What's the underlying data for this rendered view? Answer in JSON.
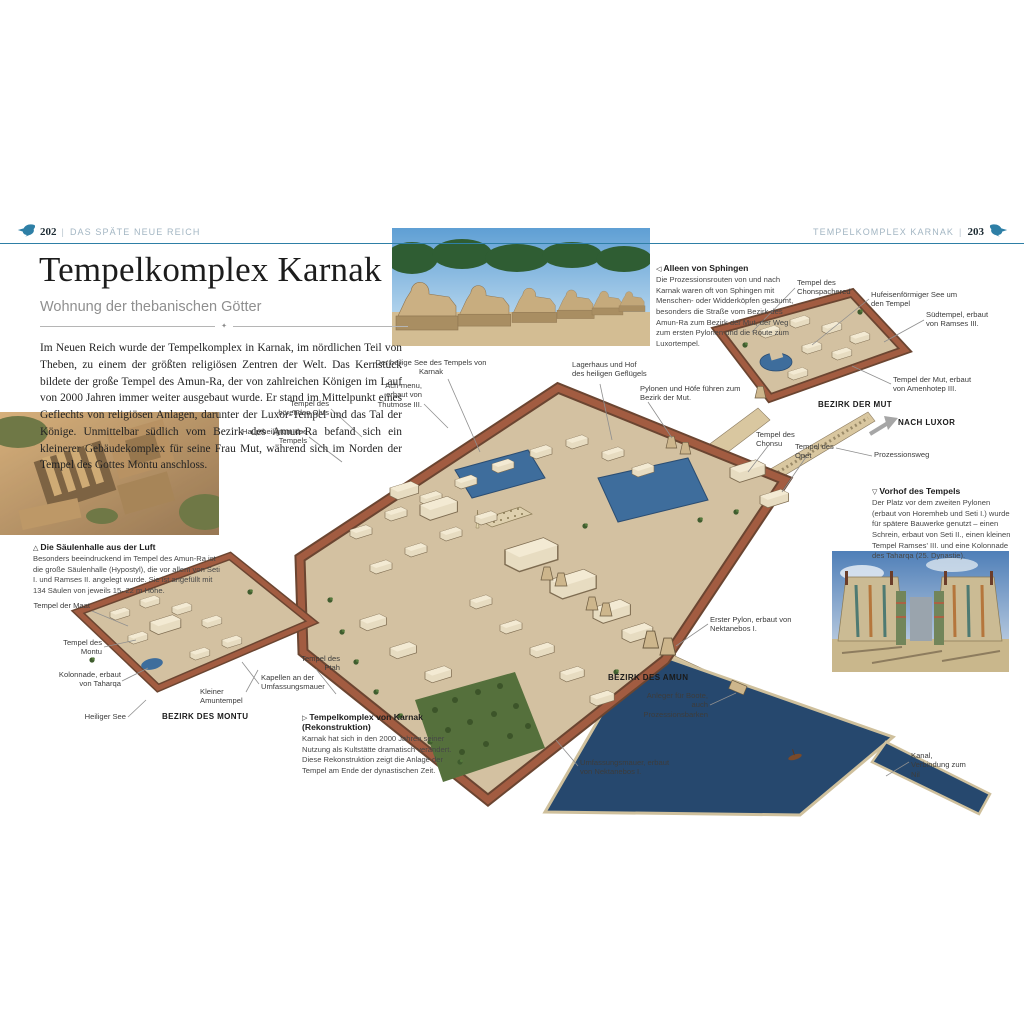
{
  "header": {
    "left_page": "202",
    "left_chapter": "DAS SPÄTE NEUE REICH",
    "right_chapter": "TEMPELKOMPLEX KARNAK",
    "right_page": "203",
    "separator": "|"
  },
  "article": {
    "title": "Tempelkomplex Karnak",
    "subtitle": "Wohnung der thebanischen Götter",
    "intro": "Im Neuen Reich wurde der Tempelkomplex in Karnak, im nördlichen Teil von Theben, zu einem der größten religiösen Zentren der Welt. Das Kernstück bildete der große Tempel des Amun-Ra, der von zahlreichen Königen im Lauf von 2000 Jahren immer weiter ausgebaut wurde. Er stand im Mittelpunkt eines Geflechts von religiösen Anlagen, darunter der Luxor-Tempel und das Tal der Könige. Unmittelbar südlich vom Bezirk des Amun-Ra befand sich ein kleinerer Gebäudekomplex für seine Frau Mut, während sich im Norden der Tempel des Gottes Montu anschloss."
  },
  "captions": {
    "sphingen": {
      "marker": "◁",
      "title": "Alleen von Sphingen",
      "body": "Die Prozessionsrouten von und nach Karnak waren oft von Sphingen mit Menschen- oder Widderköpfen gesäumt, besonders die Straße vom Bezirk des Amun-Ra zum Bezirk der Mut, der Weg zum ersten Pylonen und die Route zum Luxortempel."
    },
    "vorhof": {
      "marker": "▽",
      "title": "Vorhof des Tempels",
      "body": "Der Platz vor dem zweiten Pylonen (erbaut von Horemheb und Seti I.) wurde für spätere Bauwerke genutzt – einen Schrein, erbaut von Seti II., einen kleinen Tempel Ramses' III. und eine Kolonnade des Taharqa (25. Dynastie)."
    },
    "saeulenhalle": {
      "marker": "△",
      "title": "Die Säulenhalle aus der Luft",
      "body": "Besonders beeindruckend im Tempel des Amun-Ra ist die große Säulenhalle (Hypostyl), die vor allem von Seti I. und Ramses II. angelegt wurde. Sie ist angefüllt mit 134 Säulen von jeweils 15–22 m Höhe."
    },
    "rekonstruktion": {
      "marker": "▷",
      "title": "Tempelkomplex von Karnak (Rekonstruktion)",
      "body": "Karnak hat sich in den 2000 Jahren seiner Nutzung als Kultstätte dramatisch verändert. Diese Rekonstruktion zeigt die Anlage der Tempel am Ende der dynastischen Zeit."
    }
  },
  "labels": {
    "hoerendes_ohr": "Tempel des hörenden Ohrs",
    "hauptheiligtum": "Hauptheiligtum des Tempels",
    "ach_menu": "Ach-menu, erbaut von Thutmose III.",
    "heiliger_see_karnak": "Der heilige See des Tempels von Karnak",
    "lagerhaus": "Lagerhaus und Hof des heiligen Geflügels",
    "pylonen_hoefe": "Pylonen und Höfe führen zum Bezirk der Mut.",
    "chonspachered": "Tempel des Chonspachered",
    "hufeisen_see": "Hufeisenförmiger See um den Tempel",
    "suedtempel": "Südtempel, erbaut von Ramses III.",
    "tempel_mut": "Tempel der Mut, erbaut von Amenhotep III.",
    "tempel_chonsu": "Tempel des Chonsu",
    "tempel_opet": "Tempel des Opet",
    "prozessionsweg": "Prozessionsweg",
    "erster_pylon": "Erster Pylon, erbaut von Nektanebos I.",
    "anleger": "Anleger für Boote, auch Prozessionsbarken",
    "umfassungsmauer": "Umfassungsmauer, erbaut von Nektanebos I.",
    "kanal": "Kanal, Verbindung zum Nil",
    "tempel_maat": "Tempel der Maat",
    "tempel_montu": "Tempel des Montu",
    "kolonnade_taharqa": "Kolonnade, erbaut von Taharqa",
    "heiliger_see_montu": "Heiliger See",
    "kleiner_amuntempel": "Kleiner Amuntempel",
    "kapellen": "Kapellen an der Umfassungsmauer",
    "tempel_ptah": "Tempel des Ptah"
  },
  "zones": {
    "mut": "BEZIRK DER MUT",
    "nach_luxor": "NACH LUXOR",
    "amun": "BEZIRK DES AMUN",
    "montu": "BEZIRK DES MONTU"
  },
  "colors": {
    "accent_blue": "#2e7fa6",
    "wall_brick": "#9a5a41",
    "ground_tan": "#d3c1a1",
    "water_basin": "#26486e",
    "lake_blue": "#3e6d9c",
    "garden_green": "#55703c"
  }
}
